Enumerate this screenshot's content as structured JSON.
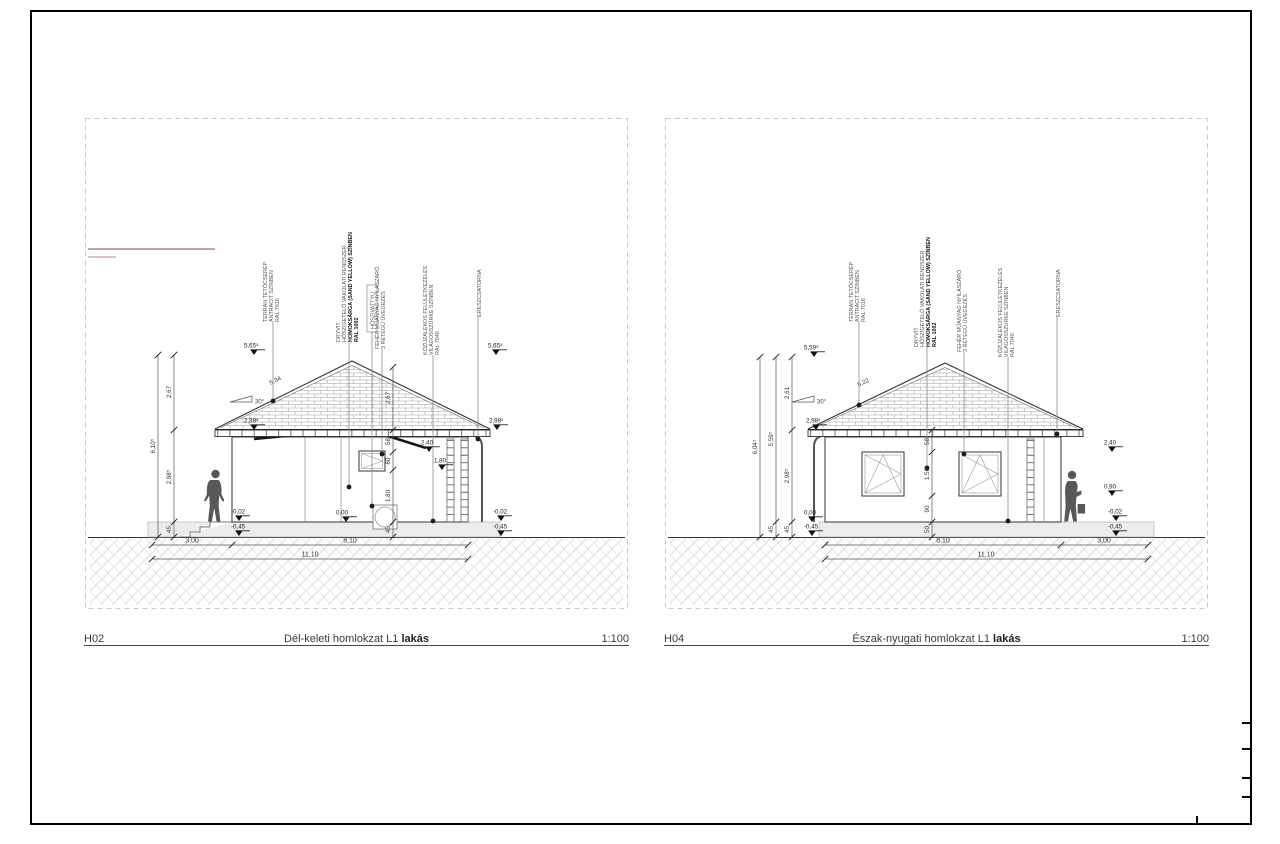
{
  "page": {
    "frame_color": "#000000"
  },
  "panels": [
    {
      "code": "H02",
      "title": "Dél-keleti homlokzat L1",
      "title_suffix": "lakás",
      "scale": "1:100",
      "leaders": [
        {
          "lines": [
            "TERRAN TETŐCSERÉP",
            "ANTRACIT SZÍNBEN",
            "RAL 7016"
          ]
        },
        {
          "lines": [
            "DRYVIT",
            "HŐSZIGETELŐ VAKOLATI RENDSZER",
            "HOMOKSÁRGA (SAND YELLOW) SZÍNBEN",
            "RAL 1002"
          ]
        },
        {
          "lines": [
            "HŐSZIVATTYÚ"
          ]
        },
        {
          "lines": [
            "FEHÉR MŰANYAG NYÍLÁSZÁRÓ",
            "3 RÉTEGŰ ÜVEGEZÉS"
          ]
        },
        {
          "lines": [
            "KŐZÚZALÉKOS FELÜLETKEZELÉS",
            "VILÁGOSSZÜRKE SZÍNBEN",
            "RAL 7040"
          ]
        },
        {
          "lines": [
            "ERESZCSATORNA"
          ]
        }
      ],
      "dims": {
        "total_height": "6,10⁵",
        "segments": [
          "45",
          "2,98⁵",
          "2,67"
        ],
        "mid_segments": [
          "45",
          "1,80",
          "60",
          "58"
        ],
        "roof_height": "2,67",
        "slope_angle": "30°",
        "slope_length": "5,34",
        "bottom": [
          "3,00",
          "8,10"
        ],
        "bottom_total": "11,10"
      },
      "levels": {
        "ridge": "5,65⁵",
        "eaves": "2,98⁵",
        "zero": "0,00",
        "minus02": "-0,02",
        "minus45": "-0,45",
        "head": "2,40",
        "sill": "1,80"
      }
    },
    {
      "code": "H04",
      "title": "Észak-nyugati homlokzat L1",
      "title_suffix": "lakás",
      "scale": "1:100",
      "leaders": [
        {
          "lines": [
            "TERRAN TETŐCSERÉP",
            "ANTRACIT SZÍNBEN",
            "RAL 7016"
          ]
        },
        {
          "lines": [
            "DRYVIT",
            "HŐSZIGETELŐ VAKOLATI RENDSZER",
            "HOMOKSÁRGA (SAND YELLOW) SZÍNBEN",
            "RAL 1002"
          ]
        },
        {
          "lines": [
            "FEHÉR MŰANYAG NYÍLÁSZÁRÓ",
            "3 RÉTEGŰ ÜVEGEZÉS"
          ]
        },
        {
          "lines": [
            "KŐZÚZALÉKOS FELÜLETKEZELÉS",
            "VILÁGOSSZÜRKE SZÍNBEN",
            "RAL 7040"
          ]
        },
        {
          "lines": [
            "ERESZCSATORNA"
          ]
        }
      ],
      "dims": {
        "total_height": "6,04⁵",
        "zero_to_ridge": "5,59⁵",
        "base": "45",
        "segments": [
          "45",
          "2,98⁵",
          "2,61"
        ],
        "mid_segments": [
          "50",
          "90",
          "1,50",
          "58"
        ],
        "slope_angle": "30°",
        "slope_length": "5,22",
        "bottom": [
          "8,10",
          "3,00"
        ],
        "bottom_total": "11,10"
      },
      "levels": {
        "ridge": "5,59⁵",
        "eaves": "2,98⁵",
        "zero": "0,00",
        "minus02": "-0,02",
        "minus45": "-0,45",
        "head": "2,40",
        "sill": "0,90"
      }
    }
  ]
}
